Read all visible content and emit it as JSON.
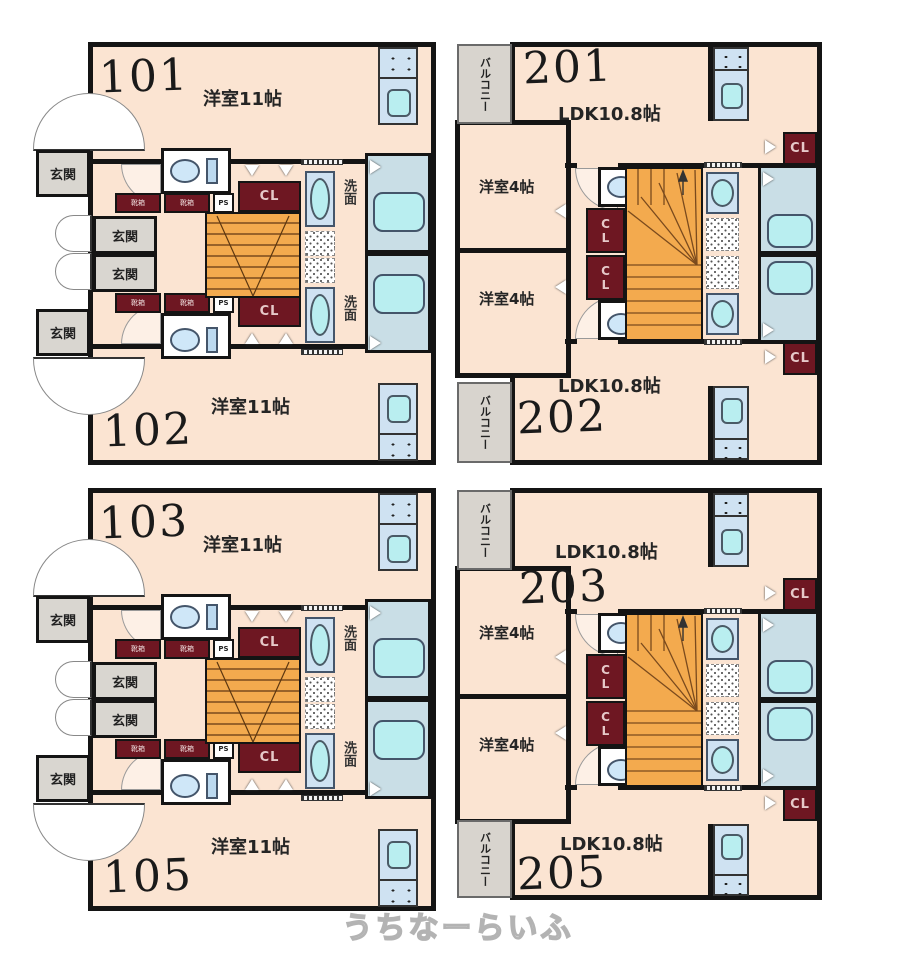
{
  "watermark": "うちなーらいふ",
  "labels": {
    "room11": "洋室11帖",
    "ldk": "LDK10.8帖",
    "room4": "洋室4帖",
    "genkan": "玄関",
    "balcony": "バルコニー",
    "washroom": "洗面",
    "closet": "CL",
    "pipe_space": "PS",
    "shoe_box": "靴箱"
  },
  "units": {
    "u101": "101",
    "u102": "102",
    "u103": "103",
    "u105": "105",
    "u201": "201",
    "u202": "202",
    "u203": "203",
    "u205": "205"
  },
  "colors": {
    "wall": "#141414",
    "room_fill": "#fbe4d2",
    "closet_fill": "#6e1722",
    "stairs_fill": "#f3aa4e",
    "entry_gray": "#d9d6d0",
    "fixture_blue": "#cfe2f2",
    "water_cyan": "#b9eef0",
    "bath_fill": "#c9dee6"
  }
}
